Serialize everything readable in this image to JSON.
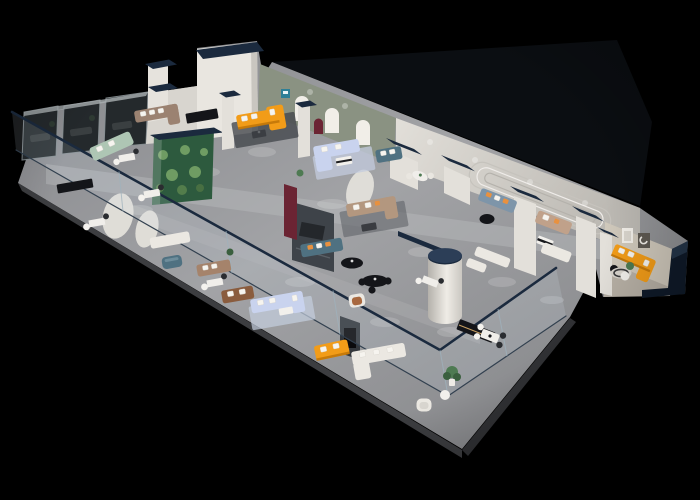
{
  "scene": {
    "description": "3D isometric cutaway render of a furniture showroom floor plan viewed from above on a black background",
    "background": "#000000",
    "view": "isometric-perspective, long hall running from lower-left to upper-right"
  },
  "palette": {
    "background": "#000000",
    "floor": "#97989b",
    "floor_light": "#b6b7ba",
    "floor_edge": "#3c3d40",
    "wing_floor": "#b7b0a5",
    "wall": "#e9e6e0",
    "wall_mid": "#d8d5cf",
    "wall_shadow": "#c6c3bd",
    "navy": "#1b2a3e",
    "navy_dark": "#0f1a29",
    "glass_smoke": "#24292c",
    "glass_tint": "#d7e4ee",
    "orange": "#f29c18",
    "orange_shadow": "#bf7407",
    "periwinkle": "#c9d3ee",
    "tan": "#b3977f",
    "taupe": "#9b8271",
    "brown": "#8a5c3e",
    "sage": "#aec6b4",
    "teal": "#4f7181",
    "bluegray": "#7e95a9",
    "cream": "#ebe8e2",
    "charcoal": "#3e4349",
    "maroon": "#6b2433",
    "arch_wall": "#8a9282",
    "terrarium": "#2d5a3e",
    "plant": "#4e7a52",
    "rug_dark": "#45484e",
    "rug_blue": "#c3cbdd",
    "black_furniture": "#141519",
    "logo_teal": "#2e7f96"
  },
  "items": [
    {
      "name": "smoked-glass-meeting-rooms",
      "color": "glass_smoke",
      "count": 3
    },
    {
      "name": "plant-terrarium-glass-wall",
      "color": "terrarium"
    },
    {
      "name": "arched-display-wall",
      "color": "arch_wall",
      "arches": 3
    },
    {
      "name": "orange-sectional-sofa-lounge",
      "color": "orange"
    },
    {
      "name": "orange-sofa-front",
      "color": "orange"
    },
    {
      "name": "orange-sectional-sofa-east-wing",
      "color": "orange"
    },
    {
      "name": "periwinkle-sectional-sofa-upper",
      "color": "periwinkle"
    },
    {
      "name": "periwinkle-sectional-sofa-lower",
      "color": "periwinkle"
    },
    {
      "name": "tan-sectional-sofa",
      "color": "tan"
    },
    {
      "name": "taupe-sectional-sofa",
      "color": "taupe"
    },
    {
      "name": "sage-green-sofa",
      "color": "sage"
    },
    {
      "name": "teal-sofa-with-orange-pillows",
      "color": "teal"
    },
    {
      "name": "teal-loveseat",
      "color": "teal"
    },
    {
      "name": "teal-ottoman",
      "color": "teal"
    },
    {
      "name": "bluegray-sofa",
      "color": "bluegray"
    },
    {
      "name": "brown-leather-sofa",
      "color": "brown"
    },
    {
      "name": "cream-sofa-sets",
      "color": "cream"
    },
    {
      "name": "white-barrel-armchair",
      "color": "cream"
    },
    {
      "name": "cognac-armchair",
      "color": "cream"
    },
    {
      "name": "black-credenzas-and-coffee-tables",
      "color": "black_furniture"
    },
    {
      "name": "white-office-desk-clusters",
      "color": "cream",
      "count": 5
    },
    {
      "name": "round-column-navy-cap",
      "color": "wall"
    },
    {
      "name": "charcoal-media-wall",
      "color": "charcoal"
    },
    {
      "name": "maroon-accent-panel",
      "color": "maroon"
    },
    {
      "name": "navy-capped-partition-walls",
      "color": "navy"
    },
    {
      "name": "glass-balustrade-navy-rail",
      "color": "glass_tint"
    },
    {
      "name": "racetrack-wall-moulding",
      "color": "wall_shadow"
    },
    {
      "name": "wing-art-frames",
      "color": "wall"
    },
    {
      "name": "potted-plants",
      "color": "plant"
    }
  ]
}
